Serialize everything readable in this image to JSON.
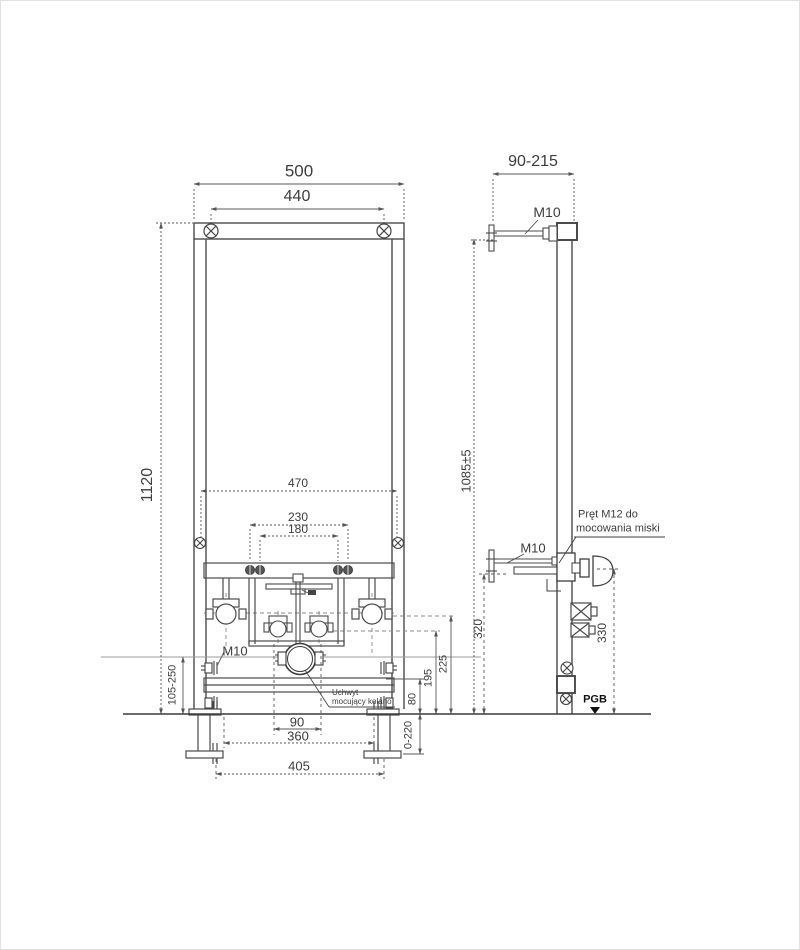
{
  "front_view": {
    "dim_width_outer": "500",
    "dim_width_bolts": "440",
    "dim_height": "1120",
    "dim_side_bolt_span": "470",
    "dim_supply_outer": "230",
    "dim_supply_inner": "180",
    "dim_bracket_height_range": "105-250",
    "bolt_label": "M10",
    "clamp_note_line1": "Uchwyt",
    "clamp_note_line2": "mocujący kolano",
    "dim_clamp_span": "90",
    "dim_leg_span": "360",
    "dim_foot_span": "405",
    "dim_upper_fitting_height": "225",
    "dim_mid_fitting_height": "195",
    "dim_rail_height": "80",
    "dim_leg_extension": "0-220"
  },
  "side_view": {
    "dim_depth_range": "90-215",
    "top_bolt_label": "M10",
    "dim_height_tol": "1085±5",
    "mid_bolt_label": "M10",
    "rod_note_line1": "Pręt M12 do",
    "rod_note_line2": "mocowania miski",
    "dim_rod_height": "320",
    "dim_bowl_rod_height": "330",
    "brand": "PGB"
  }
}
